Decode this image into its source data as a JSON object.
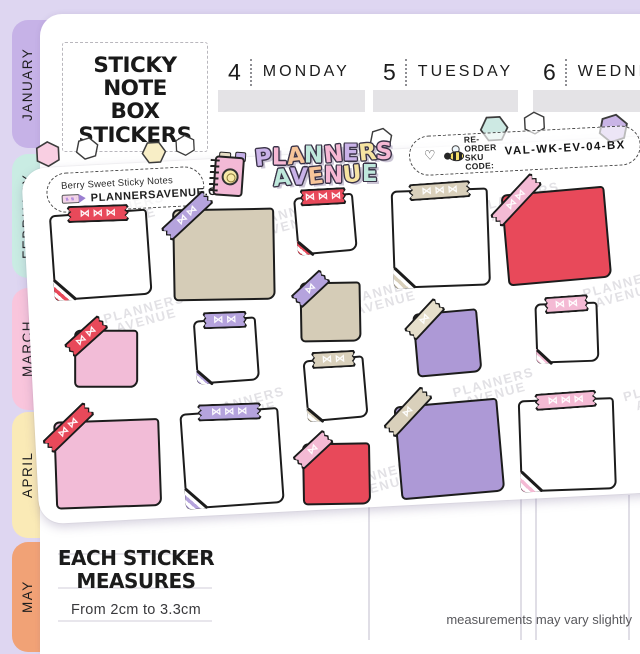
{
  "title": {
    "line1": "STICKY NOTE",
    "line2": "BOX",
    "line3": "STICKERS"
  },
  "calendar": {
    "days": [
      {
        "num": "4",
        "name": "MONDAY",
        "x": 218,
        "width": 147
      },
      {
        "num": "5",
        "name": "TUESDAY",
        "x": 373,
        "width": 145
      },
      {
        "num": "6",
        "name": "WEDNESDAY",
        "x": 533,
        "width": 150
      }
    ]
  },
  "tabs": [
    {
      "label": "JANUARY",
      "color": "#c6b2e7",
      "top": 20,
      "height": 128
    },
    {
      "label": "FEBRUARY",
      "color": "#c9ece3",
      "top": 154,
      "height": 124
    },
    {
      "label": "MARCH",
      "color": "#f9c5dc",
      "top": 288,
      "height": 122
    },
    {
      "label": "APRIL",
      "color": "#faeab6",
      "top": 412,
      "height": 126
    },
    {
      "label": "MAY",
      "color": "#f1a276",
      "top": 542,
      "height": 110
    }
  ],
  "sheet": {
    "label_name": "Berry Sweet Sticky Notes",
    "label_site": "PLANNERSAVENUE.COM",
    "logo_line1": "PLANNERS",
    "logo_line2": "AVENUE",
    "logo_line1_colors": [
      "#c9b2e8",
      "#f6b8d4",
      "#f7c59a",
      "#bfe8dc",
      "#f6b8d4",
      "#c9b2e8",
      "#f6e3a1",
      "#f6b8d4"
    ],
    "logo_line2_colors": [
      "#bfe8dc",
      "#c9b2e8",
      "#f7c59a",
      "#f6b8d4",
      "#f6e3a1",
      "#bfe8dc"
    ],
    "reorder_line1": "RE-ORDER",
    "reorder_line2": "SKU CODE:",
    "sku": "VAL-WK-EV-04-BX",
    "heart_glyph": "♡",
    "bow_glyph": "⋈",
    "watermark_line1": "PLANNERS",
    "watermark_line2": "AVENUE",
    "watermarks": [
      {
        "x": 60,
        "y": 38
      },
      {
        "x": 225,
        "y": 52
      },
      {
        "x": 455,
        "y": 48
      },
      {
        "x": 75,
        "y": 140
      },
      {
        "x": 315,
        "y": 135
      },
      {
        "x": 555,
        "y": 140
      },
      {
        "x": 170,
        "y": 238
      },
      {
        "x": 420,
        "y": 232
      },
      {
        "x": 590,
        "y": 245
      },
      {
        "x": 300,
        "y": 318
      }
    ],
    "hexagons": [
      {
        "x": 14,
        "y": -27,
        "size": 27,
        "fill": "#f9cfe2"
      },
      {
        "x": 55,
        "y": -29,
        "size": 24,
        "fill": "#ffffff"
      },
      {
        "x": 121,
        "y": -22,
        "size": 25,
        "fill": "#f8eec6"
      },
      {
        "x": 154,
        "y": -26,
        "size": 22,
        "fill": "#ffffff"
      },
      {
        "x": 349,
        "y": -23,
        "size": 24,
        "fill": "#ffffff"
      },
      {
        "x": 460,
        "y": -30,
        "size": 29,
        "fill": "#cde9e3"
      },
      {
        "x": 503,
        "y": -31,
        "size": 24,
        "fill": "#ffffff"
      },
      {
        "x": 578,
        "y": -25,
        "size": 31,
        "fill": "#c9b4e6"
      }
    ],
    "stickers": [
      {
        "note": "white",
        "x": 26,
        "y": 47,
        "w": 98,
        "h": 86,
        "rot": -1,
        "tape": {
          "style": "top",
          "color": "red",
          "bows": 3,
          "w": 62
        },
        "fold": "red"
      },
      {
        "note": "tan",
        "x": 147,
        "y": 50,
        "w": 102,
        "h": 92,
        "rot": 2,
        "tape": {
          "style": "corner",
          "color": "purple",
          "bows": 2,
          "w": 58
        },
        "fold": null
      },
      {
        "note": "white",
        "x": 271,
        "y": 42,
        "w": 60,
        "h": 58,
        "rot": -2,
        "tape": {
          "style": "top",
          "color": "red",
          "bows": 3,
          "w": 46
        },
        "fold": "red"
      },
      {
        "note": "white",
        "x": 367,
        "y": 42,
        "w": 97,
        "h": 98,
        "rot": 1,
        "tape": {
          "style": "top",
          "color": "tan",
          "bows": 3,
          "w": 62
        },
        "fold": "tan"
      },
      {
        "note": "red",
        "x": 479,
        "y": 49,
        "w": 104,
        "h": 92,
        "rot": -2,
        "tape": {
          "style": "corner",
          "color": "pink",
          "bows": 2,
          "w": 60
        },
        "fold": null
      },
      {
        "note": "pink",
        "x": 43,
        "y": 165,
        "w": 64,
        "h": 58,
        "rot": 3,
        "tape": {
          "style": "corner",
          "color": "red",
          "bows": 2,
          "w": 46
        },
        "fold": null
      },
      {
        "note": "white",
        "x": 164,
        "y": 160,
        "w": 63,
        "h": 64,
        "rot": -1,
        "tape": {
          "style": "top",
          "color": "purple",
          "bows": 2,
          "w": 44
        },
        "fold": "purple"
      },
      {
        "note": "tan",
        "x": 271,
        "y": 129,
        "w": 61,
        "h": 60,
        "rot": 2,
        "tape": {
          "style": "corner",
          "color": "purple",
          "bows": 1,
          "w": 40
        },
        "fold": null
      },
      {
        "note": "purple",
        "x": 384,
        "y": 164,
        "w": 65,
        "h": 64,
        "rot": -2,
        "tape": {
          "style": "corner",
          "color": "cream",
          "bows": 1,
          "w": 44
        },
        "fold": null
      },
      {
        "note": "white",
        "x": 505,
        "y": 162,
        "w": 63,
        "h": 60,
        "rot": 1,
        "tape": {
          "style": "top",
          "color": "pink",
          "bows": 2,
          "w": 44
        },
        "fold": "pink"
      },
      {
        "note": "white",
        "x": 272,
        "y": 205,
        "w": 61,
        "h": 62,
        "rot": -2,
        "tape": {
          "style": "top",
          "color": "tan",
          "bows": 2,
          "w": 44
        },
        "fold": "tan"
      },
      {
        "note": "pink",
        "x": 18,
        "y": 255,
        "w": 106,
        "h": 88,
        "rot": 1,
        "tape": {
          "style": "corner",
          "color": "red",
          "bows": 2,
          "w": 58
        },
        "fold": null
      },
      {
        "note": "white",
        "x": 146,
        "y": 252,
        "w": 99,
        "h": 96,
        "rot": -1,
        "tape": {
          "style": "top",
          "color": "purple",
          "bows": 3,
          "w": 64
        },
        "fold": "purple"
      },
      {
        "note": "red",
        "x": 265,
        "y": 290,
        "w": 68,
        "h": 62,
        "rot": 2,
        "tape": {
          "style": "corner",
          "color": "pink",
          "bows": 1,
          "w": 42
        },
        "fold": null
      },
      {
        "note": "purple",
        "x": 361,
        "y": 255,
        "w": 104,
        "h": 94,
        "rot": -2,
        "tape": {
          "style": "corner",
          "color": "tan",
          "bows": 1,
          "w": 56
        },
        "fold": null
      },
      {
        "note": "white",
        "x": 483,
        "y": 258,
        "w": 96,
        "h": 92,
        "rot": 1,
        "tape": {
          "style": "top",
          "color": "pink",
          "bows": 3,
          "w": 62
        },
        "fold": "pink"
      }
    ]
  },
  "footer": {
    "measure_line1": "EACH STICKER",
    "measure_line2": "MEASURES",
    "measure_range": "From 2cm to 3.3cm",
    "disclaimer": "measurements may vary slightly"
  },
  "colors": {
    "background": "#ded6f1",
    "page": "#ffffff",
    "note_white": "#ffffff",
    "note_tan": "#d5ccb7",
    "note_pink": "#f2bcd7",
    "note_red": "#e8495a",
    "note_purple": "#ad99d6",
    "tape_red": "#e8495a",
    "tape_purple": "#b5a3dd",
    "tape_pink": "#f4bad4",
    "tape_tan": "#d9d0bb",
    "tape_cream": "#e6dfcb"
  }
}
